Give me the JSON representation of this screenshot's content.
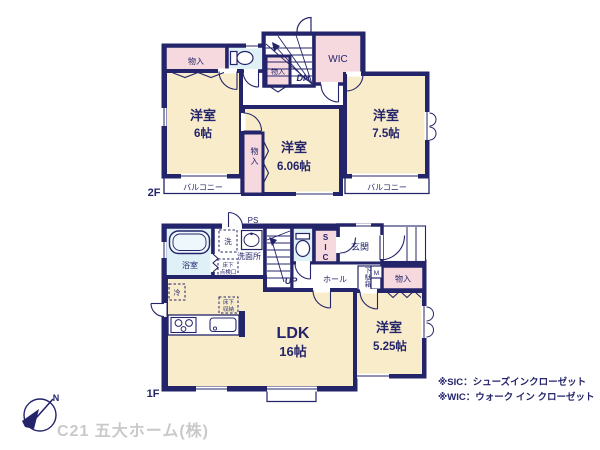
{
  "floor2": {
    "label": "2F",
    "closet_top_left": "物入",
    "closet_stair": "物入",
    "closet_center": "物入",
    "wic": "WIC",
    "stairs_dn": "DN",
    "room_west": {
      "name": "洋室",
      "size": "6帖"
    },
    "room_center": {
      "name": "洋室",
      "size": "6.06帖"
    },
    "room_east": {
      "name": "洋室",
      "size": "7.5帖"
    },
    "balcony_west": "バルコニー",
    "balcony_east": "バルコニー"
  },
  "floor1": {
    "label": "1F",
    "bath": "浴室",
    "washer": "洗",
    "washroom": "洗面所",
    "ps": "PS",
    "underfloor_hatch_line1": "床下",
    "underfloor_hatch_line2": "点検口",
    "stairs_up": "UP",
    "sic": "SIC",
    "entrance": "玄関",
    "hall": "ホール",
    "shoe_cabinet": "下駄箱",
    "meter": "M",
    "closet": "物入",
    "fridge": "冷",
    "underfloor_storage_line1": "床下",
    "underfloor_storage_line2": "収納",
    "ldk": {
      "name": "LDK",
      "size": "16帖"
    },
    "room_east": {
      "name": "洋室",
      "size": "5.25帖"
    }
  },
  "notes": {
    "sic": "※SIC：シューズインクローゼット",
    "wic": "※WIC：ウォーク イン クローゼット"
  },
  "footer": {
    "company": "C21 五大ホーム(株)",
    "compass_north": "N"
  },
  "colors": {
    "wall": "#24246b",
    "room_fill": "#f8ecca",
    "closet_fill": "#f6d9de",
    "wet_area_fill": "#dff0f7",
    "company_text": "#c9c9c9"
  }
}
